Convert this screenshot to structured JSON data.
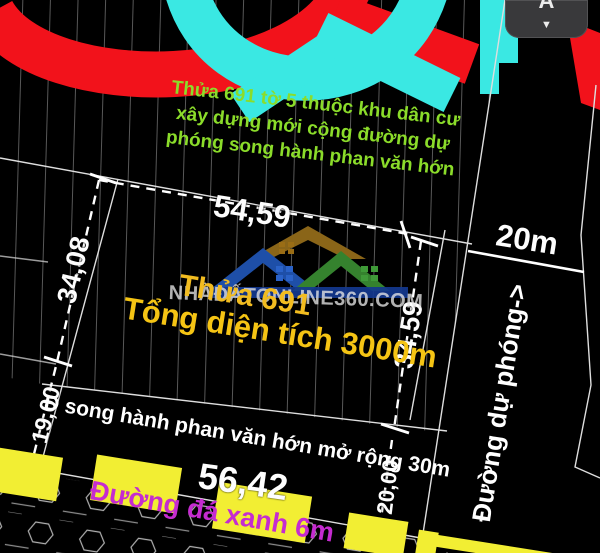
{
  "logo": {
    "site_text": "NHÀĐẤTONLINE360.COM"
  },
  "header_note": {
    "line1": "Thửa 691 tờ 5 thuộc khu dân cư",
    "line2": "xây dựng mới cộng đường dự",
    "line3": "phóng song hành phan văn hớn"
  },
  "parcel": {
    "title": "Thửa 691",
    "area": "Tổng diện tích 3000m"
  },
  "dimensions": {
    "top": "54,59",
    "left_upper": "34,08",
    "left_lower": "19,00",
    "right_upper": "34,59",
    "right_lower": "20,00",
    "bottom": "56,42",
    "planned_road_width": "20m"
  },
  "roads": {
    "parallel_road": "Đ song hành phan văn hớn mở rộng 30m",
    "stone_road": "Đường đá xanh 6m",
    "planned_road": "Đường dự phóng->"
  },
  "controls": {
    "font_button_label": "A",
    "collapse_arrow": "▼"
  },
  "colors": {
    "note_green": "#8BDC2A",
    "parcel_yellow": "#F2BC20",
    "area_yellow": "#F5C414",
    "road_magenta": "#C52BD0",
    "highlight_yellow": "#F2EE33",
    "logo_red": "#F2121B",
    "logo_cyan": "#3AE8E3",
    "roof_blue": "#1E4FA8",
    "roof_olive": "#8A6518",
    "roof_green": "#35822E",
    "dim_white": "#FFFFFF"
  }
}
